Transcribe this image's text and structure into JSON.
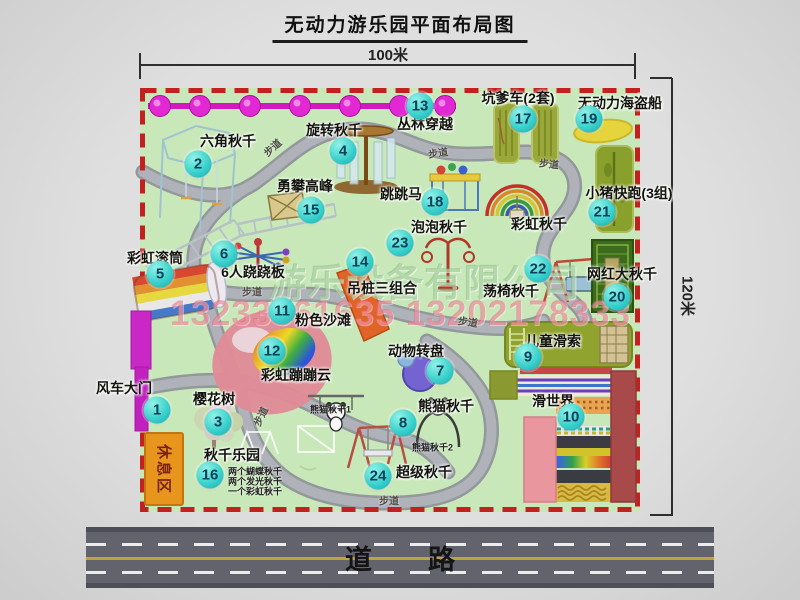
{
  "title": "无动力游乐园平面布局图",
  "dimensions": {
    "width": "100米",
    "height": "120米"
  },
  "road": {
    "label": "道路"
  },
  "walkway": {
    "label": "步道"
  },
  "rest_area": {
    "label": "休息区"
  },
  "watermark": {
    "company": "游乐设备有限公司",
    "phone": "13233861635 13202178333"
  },
  "unnumbered": {
    "rainbow_swing": "彩虹秋千"
  },
  "attractions": [
    {
      "id": 1,
      "name": "风车大门"
    },
    {
      "id": 2,
      "name": "六角秋千"
    },
    {
      "id": 3,
      "name": "樱花树"
    },
    {
      "id": 4,
      "name": "旋转秋千"
    },
    {
      "id": 5,
      "name": "彩虹滚筒"
    },
    {
      "id": 6,
      "name": "6人跷跷板"
    },
    {
      "id": 7,
      "name": "动物转盘"
    },
    {
      "id": 8,
      "name": "熊猫秋千",
      "notes": [
        "熊猫秋千1",
        "熊猫秋千2"
      ]
    },
    {
      "id": 9,
      "name": "儿童滑索"
    },
    {
      "id": 10,
      "name": "滑世界"
    },
    {
      "id": 11,
      "name": "粉色沙滩"
    },
    {
      "id": 12,
      "name": "彩虹蹦蹦云"
    },
    {
      "id": 13,
      "name": "丛林穿越"
    },
    {
      "id": 14,
      "name": "吊桩三组合"
    },
    {
      "id": 15,
      "name": "勇攀高峰"
    },
    {
      "id": 16,
      "name": "秋千乐园",
      "notes": [
        "两个蝴蝶秋千",
        "两个发光秋千",
        "一个彩虹秋千"
      ]
    },
    {
      "id": 17,
      "name": "坑爹车(2套)"
    },
    {
      "id": 18,
      "name": "跳跳马"
    },
    {
      "id": 19,
      "name": "无动力海盗船"
    },
    {
      "id": 20,
      "name": "网红大秋千"
    },
    {
      "id": 21,
      "name": "小猪快跑(3组)"
    },
    {
      "id": 22,
      "name": "荡椅秋千"
    },
    {
      "id": 23,
      "name": "泡泡秋千"
    },
    {
      "id": 24,
      "name": "超级秋千"
    }
  ]
}
